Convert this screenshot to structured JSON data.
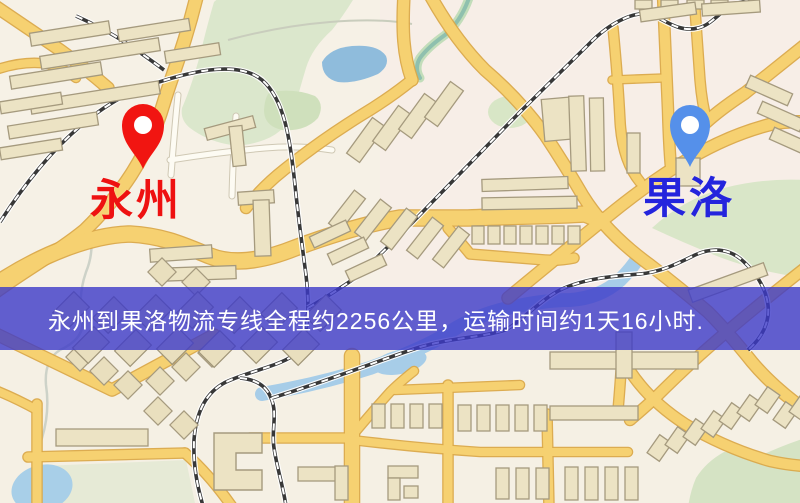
{
  "map": {
    "banner": {
      "text": "永州到果洛物流专线全程约2256公里，运输时间约1天16小时."
    },
    "origin": {
      "label": "永州"
    },
    "destination": {
      "label": "果洛"
    },
    "route": {
      "origin": "永州",
      "destination": "果洛",
      "distance_text": "约2256公里",
      "duration_text": "约1天16小时"
    },
    "colors": {
      "origin_label": "#ee1111",
      "destination_label": "#2424dd",
      "origin_pin": "#f11511",
      "destination_pin": "#5590ea",
      "banner_bg": "rgba(60,57,200,0.8)",
      "banner_text": "#ffffff"
    }
  }
}
